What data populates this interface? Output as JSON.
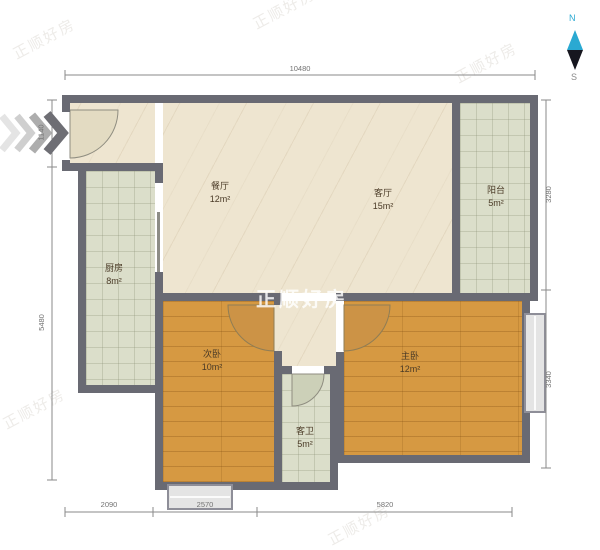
{
  "watermark": {
    "text": "正顺好房"
  },
  "compass": {
    "north": "N",
    "south": "S"
  },
  "rooms": {
    "dining": {
      "name": "餐厅",
      "area": "12m²"
    },
    "living": {
      "name": "客厅",
      "area": "15m²"
    },
    "balcony": {
      "name": "阳台",
      "area": "5m²"
    },
    "kitchen": {
      "name": "厨房",
      "area": "8m²"
    },
    "bedroom2": {
      "name": "次卧",
      "area": "10m²"
    },
    "master": {
      "name": "主卧",
      "area": "12m²"
    },
    "bath": {
      "name": "客卫",
      "area": "5m²"
    }
  },
  "dimensions": {
    "top": "10480",
    "left_upper": "1140",
    "left_lower": "5480",
    "right_upper": "3280",
    "right_lower": "3340",
    "bottom_left": "2090",
    "bottom_mid": "2570",
    "bottom_right": "5820"
  },
  "colors": {
    "wall": "#696a73",
    "floor_cream": "#eee5d0",
    "floor_tile": "#dbdeca",
    "floor_wood": "#d69942",
    "compass_north": "#2aa9d2"
  }
}
